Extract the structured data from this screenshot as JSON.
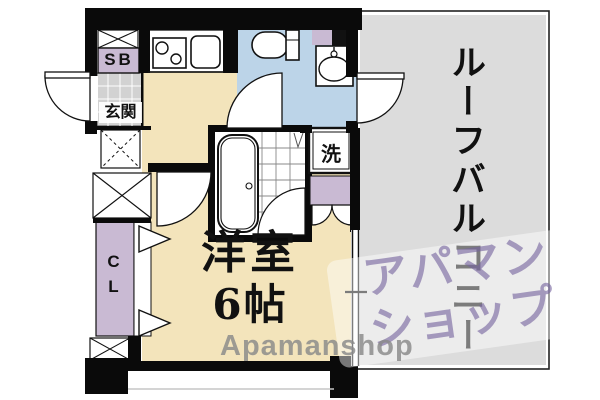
{
  "plan_title": "1R apartment floor plan",
  "rooms": {
    "main_room": {
      "label": "洋室",
      "size": "6帖"
    },
    "roof_balcony": {
      "label": "ルーフバルコニー"
    },
    "entrance": {
      "label": "玄関"
    },
    "shoe_box": {
      "label": "SB"
    },
    "closet": {
      "label": "CL"
    },
    "laundry": {
      "label": "洗"
    }
  },
  "fixtures": [
    "toilet-icon",
    "washbasin-icon",
    "bathtub-icon",
    "stove-icon",
    "kitchen-sink-icon",
    "washing-machine-pan",
    "door-arc",
    "window",
    "bifold-door-triangle",
    "shaft-cross-box"
  ],
  "watermark": {
    "latin": "Apamanshop",
    "jp_line1": "アパマン",
    "jp_line2": "ショップ"
  },
  "colors": {
    "room_beige": "#F3E4BB",
    "washroom_blue": "#BCD4E8",
    "balcony_gray": "#DCDCDC",
    "storage_lavender": "#C9BAD3",
    "entrance_tile": "#D2D2D2",
    "wall_black": "#0A0A0A",
    "watermark_purple": "#7664A0",
    "watermark_gray": "#8A8A8A"
  }
}
